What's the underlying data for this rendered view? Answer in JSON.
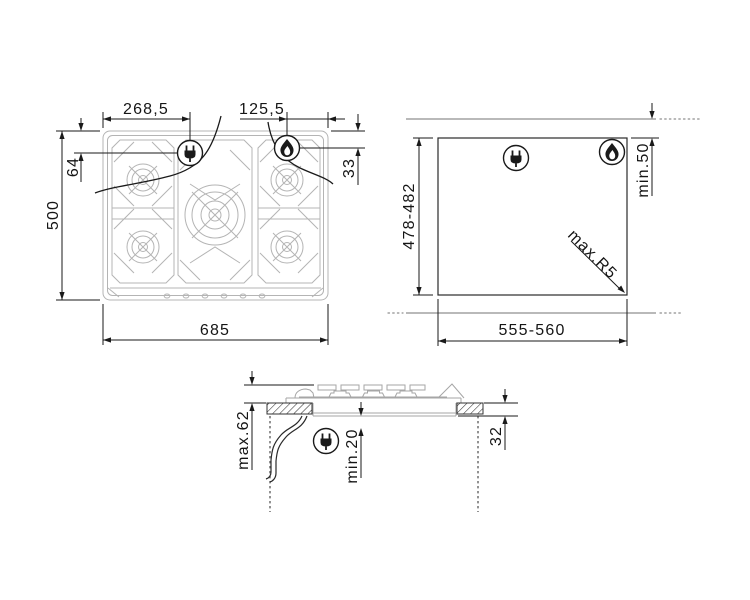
{
  "drawing": {
    "background": "#ffffff",
    "line_color": "#1a1a1a",
    "hob_line_color": "#b4b4b4",
    "worktop_line_color": "#8f8f8f"
  },
  "views": {
    "top": {
      "title": "hob-top-view",
      "dims": {
        "left_to_plug": "268,5",
        "flame_to_right": "125,5",
        "top_to_plug": "64",
        "top_to_flame": "33",
        "depth": "500",
        "width": "685"
      }
    },
    "cutout": {
      "title": "worktop-cutout-view",
      "dims": {
        "depth": "478-482",
        "width": "555-560",
        "wall_distance": "min.50",
        "corner_radius": "max.R5"
      }
    },
    "section": {
      "title": "side-section-view",
      "dims": {
        "above_worktop": "max.62",
        "clearance_below": "min.20",
        "below_worktop": "32"
      }
    }
  },
  "icons": {
    "plug": "power-plug",
    "flame": "gas-flame"
  }
}
